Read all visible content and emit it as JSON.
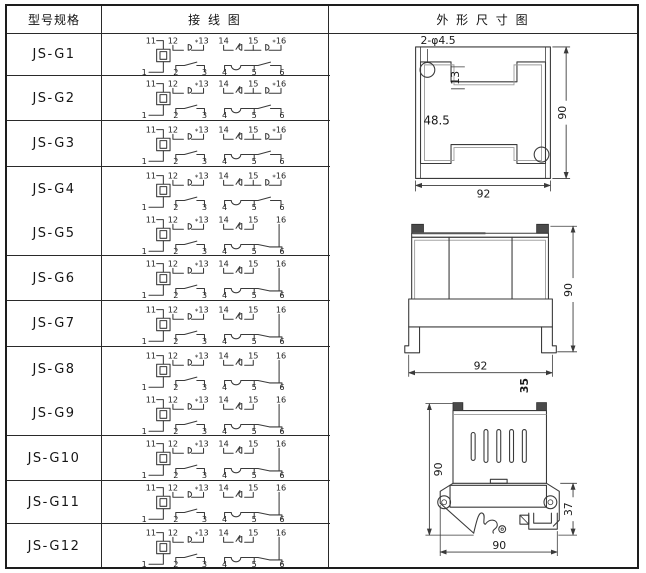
{
  "header": {
    "model": "型号规格",
    "wiring": "接 线 图",
    "outline": "外 形 尺 寸 图"
  },
  "rows": [
    {
      "model": "JS-G1",
      "variant": "A"
    },
    {
      "model": "JS-G2",
      "variant": "A"
    },
    {
      "model": "JS-G3",
      "variant": "A"
    },
    {
      "model": "JS-G4",
      "variant": "A"
    },
    {
      "model": "JS-G5",
      "variant": "B"
    },
    {
      "model": "JS-G6",
      "variant": "B"
    },
    {
      "model": "JS-G7",
      "variant": "B"
    },
    {
      "model": "JS-G8",
      "variant": "B"
    },
    {
      "model": "JS-G9",
      "variant": "B"
    },
    {
      "model": "JS-G10",
      "variant": "B"
    },
    {
      "model": "JS-G11",
      "variant": "B"
    },
    {
      "model": "JS-G12",
      "variant": "B"
    }
  ],
  "wiring": {
    "terminals_top": [
      "11",
      "12",
      "13",
      "14",
      "15",
      "16"
    ],
    "terminals_bottom": [
      "1",
      "2",
      "3",
      "4",
      "5",
      "6"
    ],
    "contact_mark": "*"
  },
  "outline": {
    "panel_cutout": {
      "holes_note": "2-φ4.5",
      "cutout_dim": "48.5",
      "notch_dim": "13",
      "height": "90",
      "width": "92"
    },
    "front_view": {
      "height": "90",
      "width": "92",
      "depth": "35"
    },
    "side_view": {
      "height": "90",
      "clamp_height": "37",
      "width": "90"
    }
  },
  "colors": {
    "line": "#3a3a3a",
    "border": "#1d1d1d",
    "background": "#ffffff",
    "tab_fill": "#4a4a4a"
  }
}
